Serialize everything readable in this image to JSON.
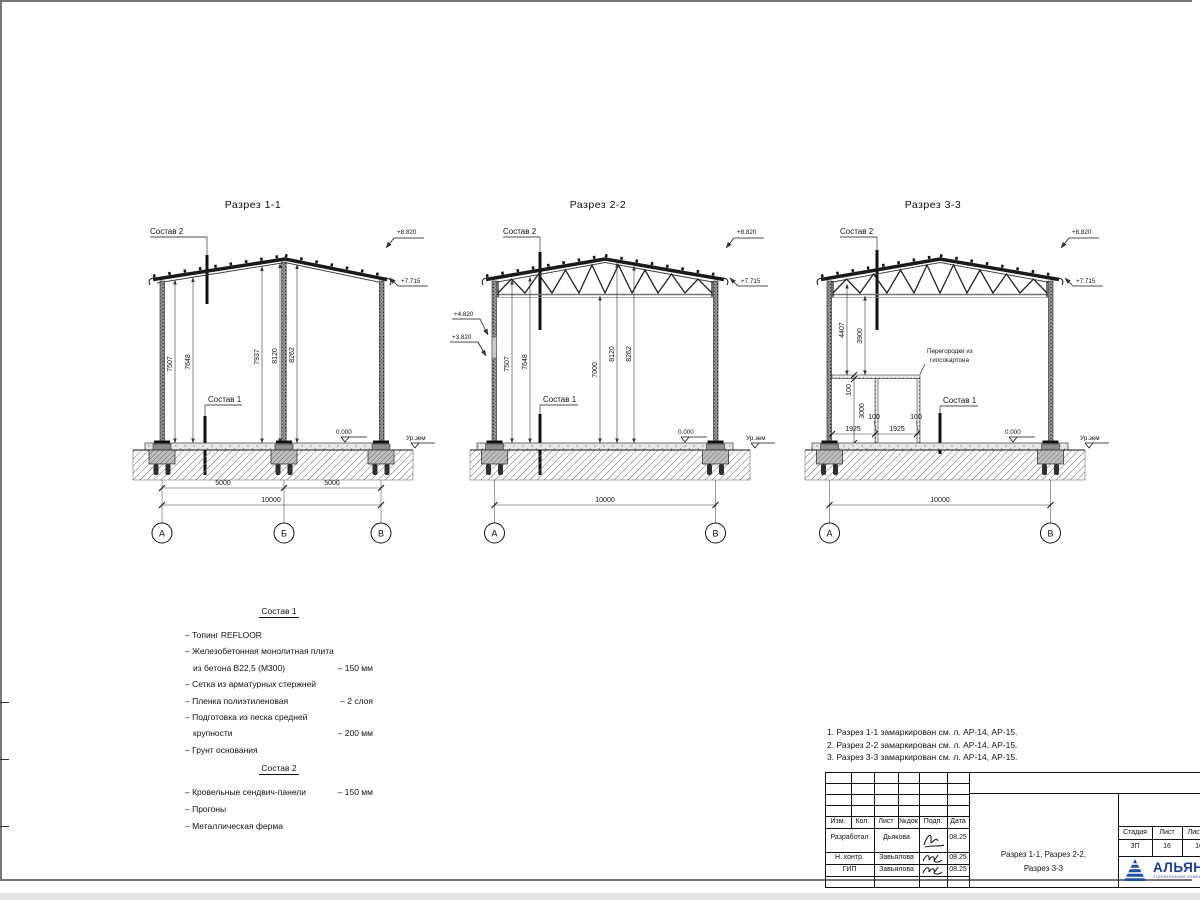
{
  "sections": [
    {
      "title": "Разрез 1-1",
      "sostav2": "Состав 2",
      "sostav1": "Состав 1",
      "elev_ridge": "+8.820",
      "elev_eave": "+7.715",
      "elev_zero": "0.000",
      "ground": "Ур.зем",
      "dims_v": [
        "7507",
        "7648",
        "7937",
        "8120",
        "8262"
      ],
      "dim_5000a": "5000",
      "dim_5000b": "5000",
      "dim_10000": "10000",
      "axes": [
        "А",
        "Б",
        "В"
      ]
    },
    {
      "title": "Разрез 2-2",
      "sostav2": "Состав 2",
      "sostav1": "Состав 1",
      "elev_ridge": "+8.820",
      "elev_eave": "+7.715",
      "elev_win_top": "+4.820",
      "elev_win_bot": "+3.820",
      "elev_zero": "0.000",
      "ground": "Ур.зем",
      "dims_v": [
        "7507",
        "7648",
        "7000",
        "8120",
        "8262"
      ],
      "dim_10000": "10000",
      "axes": [
        "А",
        "В"
      ]
    },
    {
      "title": "Разрез 3-3",
      "sostav2": "Состав 2",
      "sostav1": "Состав 1",
      "elev_ridge": "+8.820",
      "elev_eave": "+7.715",
      "elev_zero": "0.000",
      "ground": "Ур.зем",
      "dims_v": [
        "4407",
        "3900"
      ],
      "part_label1": "Перегородки из",
      "part_label2": "гипсокартона",
      "d100a": "100",
      "d3000": "3000",
      "d100b": "100",
      "d100c": "100",
      "d1925a": "1925",
      "d1925b": "1925",
      "dim_10000": "10000",
      "axes": [
        "А",
        "В"
      ]
    }
  ],
  "notes": {
    "s1_title": "Состав 1",
    "s1": [
      {
        "t": "– Топинг REFLOOR",
        "v": ""
      },
      {
        "t": "– Железобетонная  монолитная плита",
        "v": ""
      },
      {
        "t": "из бетона В22,5 (М300)",
        "v": "– 150 мм"
      },
      {
        "t": "– Сетка из арматурных стержней",
        "v": ""
      },
      {
        "t": "– Пленка полиэтиленовая",
        "v": "– 2 слоя"
      },
      {
        "t": "– Подготовка из песка средней",
        "v": ""
      },
      {
        "t": "крупности",
        "v": "– 200 мм"
      },
      {
        "t": "– Грунт основания",
        "v": ""
      }
    ],
    "s2_title": "Состав 2",
    "s2": [
      {
        "t": "– Кровельные сендвич-панели",
        "v": "– 150 мм"
      },
      {
        "t": "– Прогоны",
        "v": ""
      },
      {
        "t": "– Металлическая ферма",
        "v": ""
      }
    ]
  },
  "ref_notes": [
    "1. Разрез 1-1 замаркирован см. л. АР-14, АР-15.",
    "2. Разрез 2-2 замаркирован см. л. АР-14, АР-15.",
    "3. Разрез 3-3 замаркирован см. л. АР-14, АР-15."
  ],
  "titleblock": {
    "h_izm": "Изм.",
    "h_kol": "Кол.",
    "h_list": "Лист",
    "h_ndok": "№док",
    "h_podp": "Подп.",
    "h_data": "Дата",
    "r1_role": "Разработал",
    "r1_name": "Дьякова",
    "r1_date": "08.25",
    "r2_role": "Н. контр.",
    "r2_name": "Завьялова",
    "r2_date": "08.25",
    "r3_role": "ГИП",
    "r3_name": "Завьялова",
    "r3_date": "08.25",
    "title_line1": "Разрез 1-1, Разрез 2-2,",
    "title_line2": "Разрез 3-3",
    "h_stage": "Стадия",
    "h_sheet": "Лист",
    "h_sheets": "Листов",
    "stage": "ЗП",
    "sheet": "16",
    "sheets": "16",
    "logo": "АЛЬЯНС",
    "logo_sub": "строительная компания",
    "logo_color": "#1d4fa0"
  }
}
